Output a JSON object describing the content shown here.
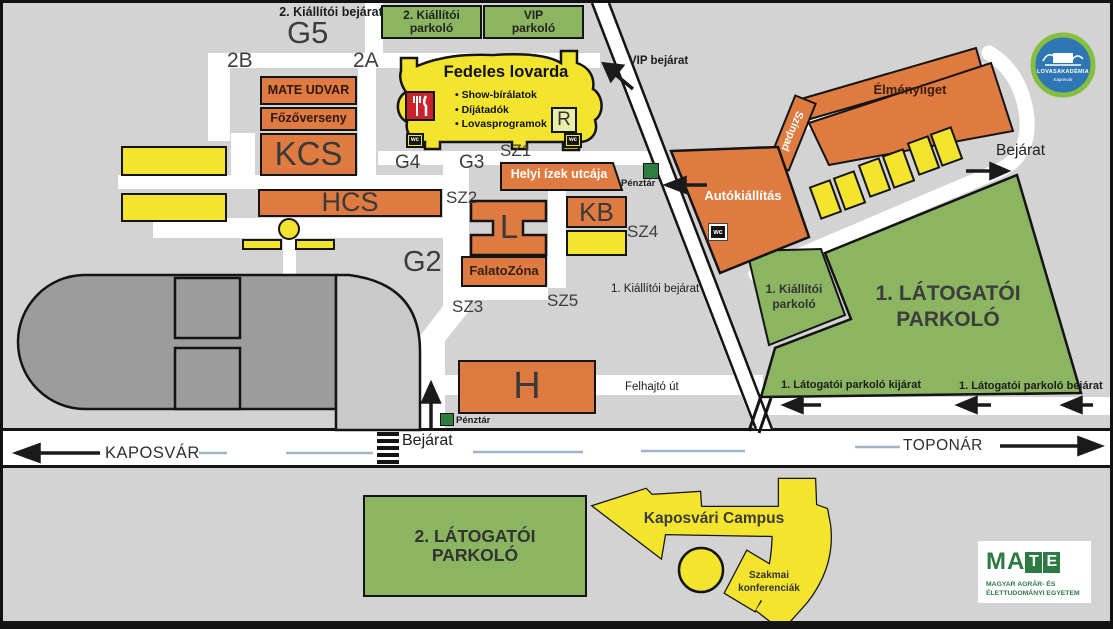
{
  "colors": {
    "background": "#d3d3d3",
    "road": "#ffffff",
    "building_orange": "#df7b41",
    "building_yellow": "#f3e42e",
    "parking_green": "#8cb561",
    "cashier_green": "#2e7c3e",
    "restaurant_red": "#c9242b",
    "stadium_gray": "#9c9c9c",
    "stadium_light_gray": "#c9c9c9",
    "centerline_blue": "#9fb4c6",
    "mate_green": "#2d7a44",
    "logo_blue": "#2f76b5",
    "logo_ring_green": "#86bf3f"
  },
  "top": {
    "exhibitor_entrance2": "2. Kiállítói bejárat",
    "g5": "G5",
    "b2": "2B",
    "a2": "2A",
    "parking2_line1": "2. Kiállítói",
    "parking2_line2": "parkoló",
    "vip_line1": "VIP",
    "vip_line2": "parkoló",
    "vip_entrance": "VIP bejárat"
  },
  "bld": {
    "mate_udvar": "MATE UDVAR",
    "fozoverseny": "Főzőverseny",
    "kcs": "KCS",
    "hcs": "HCS",
    "kb": "KB",
    "l": "L",
    "h": "H",
    "r": "R",
    "wc": "wc",
    "lovarda_title": "Fedeles lovarda",
    "lovarda_items": [
      "Show-bírálatok",
      "Díjátadók",
      "Lovasprogramok"
    ],
    "helyi_izek": "Helyi ízek utcája",
    "falatozona": "FalatoZóna",
    "autokiallitas": "Autókiállítás",
    "szinpad": "Színpad",
    "elmenyliget": "Élményliget"
  },
  "sec": {
    "g4": "G4",
    "g3": "G3",
    "g2": "G2",
    "sz1": "SZ1",
    "sz2": "SZ2",
    "sz3": "SZ3",
    "sz4": "SZ4",
    "sz5": "SZ5"
  },
  "park": {
    "v1_line1": "1. LÁTOGATÓI",
    "v1_line2": "PARKOLÓ",
    "v2_line1": "2. LÁTOGATÓI",
    "v2_line2": "PARKOLÓ",
    "k1_line1": "1. Kiállítói",
    "k1_line2": "parkoló",
    "v1_exit": "1. Látogatói parkoló kijárat",
    "v1_entry": "1. Látogatói parkoló bejárat"
  },
  "roads": {
    "kaposvar": "KAPOSVÁR",
    "toponar": "TOPONÁR",
    "felhajto": "Felhajtó út",
    "k1_entrance": "1. Kiállítói bejárat",
    "bejarat": "Bejárat",
    "penztar": "Pénztár"
  },
  "campus": {
    "title": "Kaposvári Campus",
    "conf1": "Szakmai",
    "conf2": "konferenciák"
  },
  "logos": {
    "mate": {
      "m": "M",
      "a": "A",
      "t": "T",
      "e": "E",
      "sub1": "MAGYAR AGRÁR- ÉS",
      "sub2": "ÉLETTUDOMÁNYI EGYETEM"
    },
    "lovas": {
      "name": "LOVASAKADÉMIA",
      "city": "Kaposvár"
    }
  }
}
